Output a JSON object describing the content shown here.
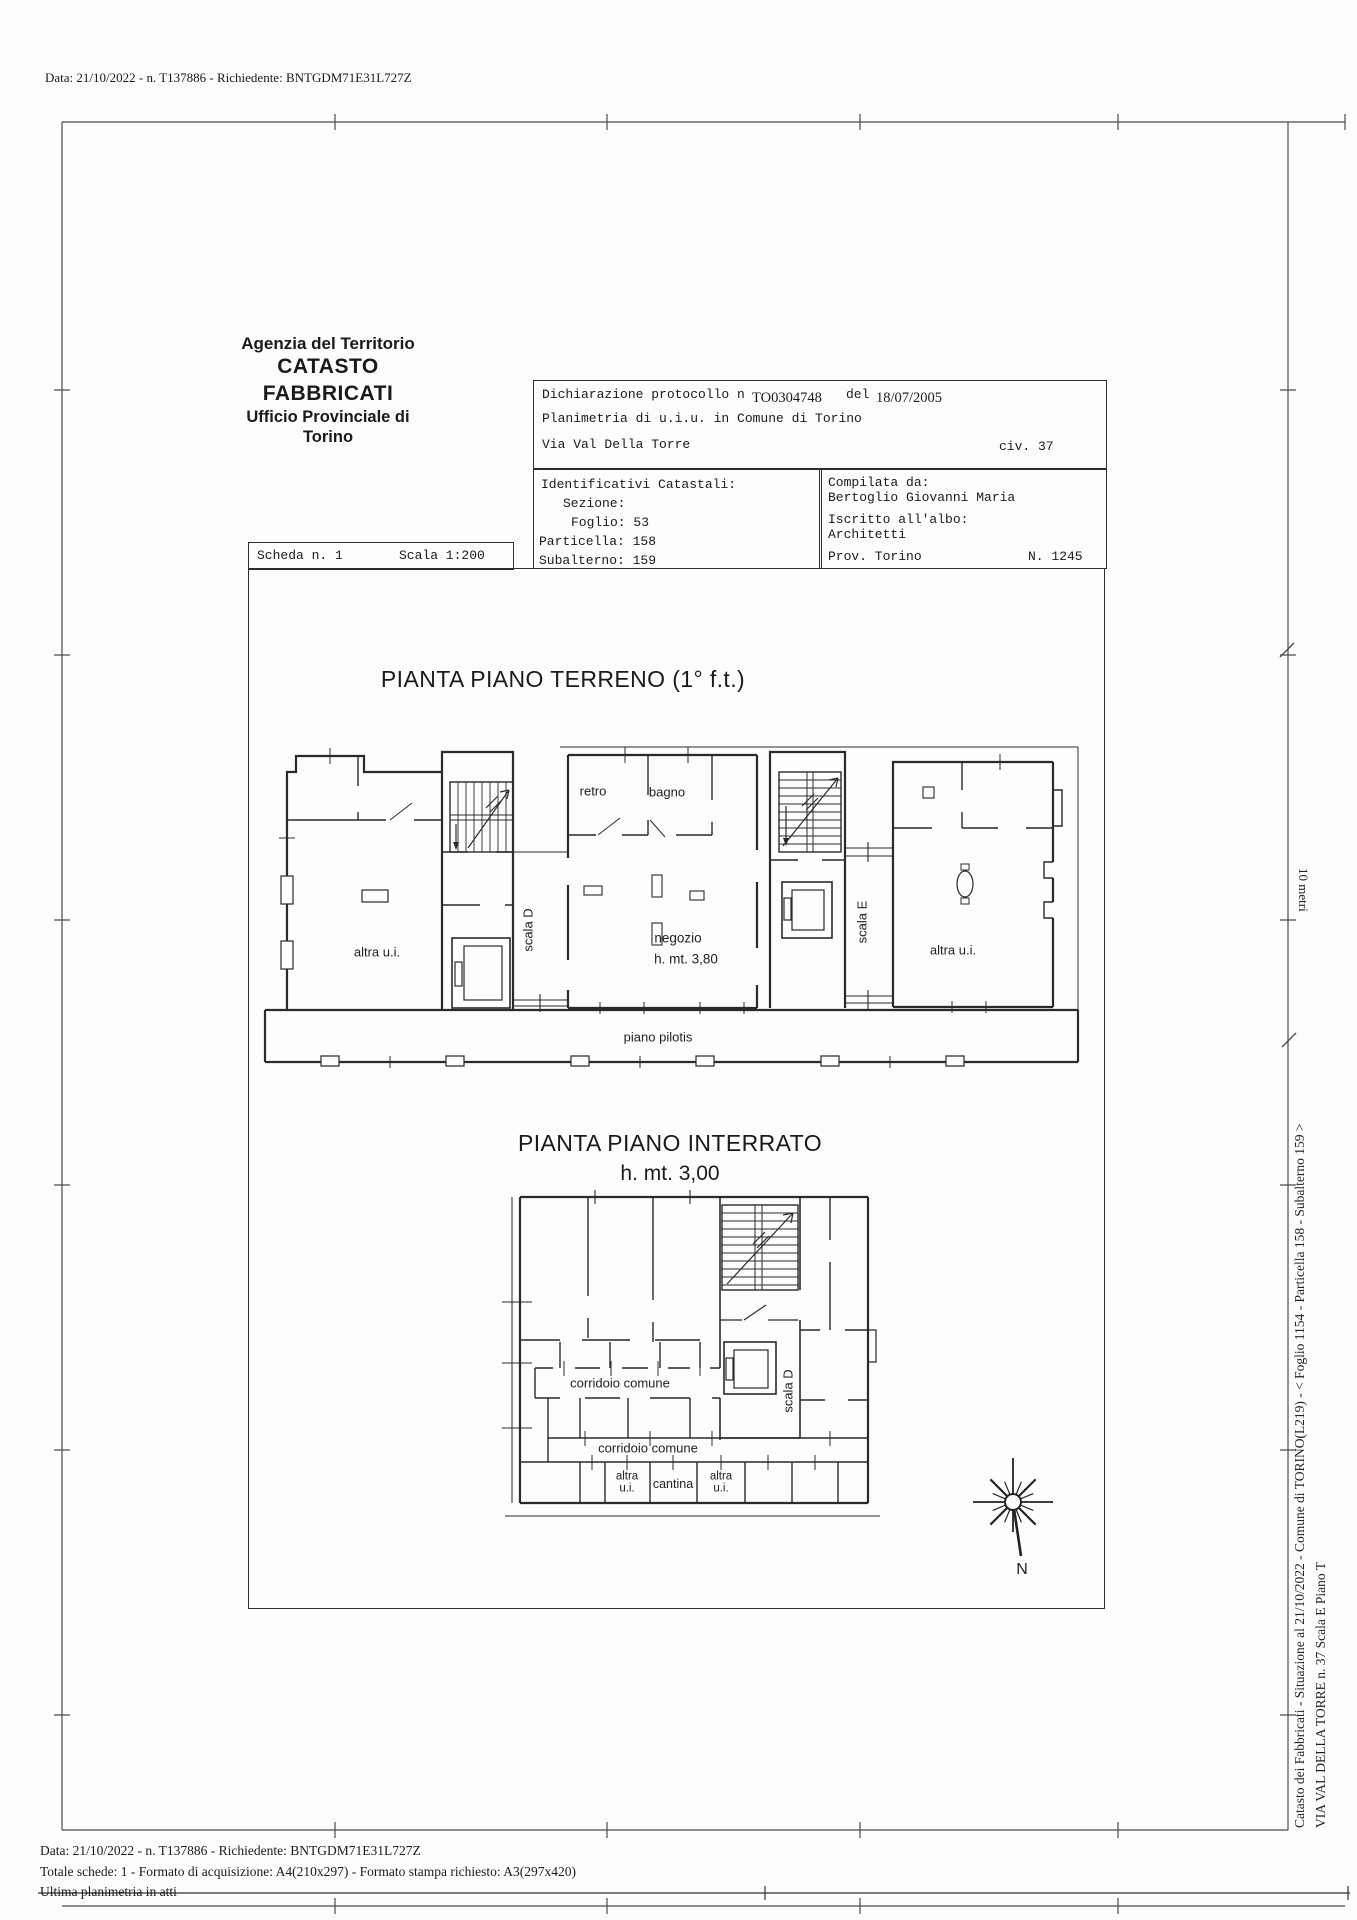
{
  "meta": {
    "top_note": "Data: 21/10/2022 - n. T137886 - Richiedente: BNTGDM71E31L727Z"
  },
  "agency": {
    "line1": "Agenzia del Territorio",
    "line2": "CATASTO FABBRICATI",
    "line3": "Ufficio Provinciale di",
    "line4": "Torino"
  },
  "declaration": {
    "protocol_label": "Dichiarazione protocollo n",
    "protocol_number": "TO0304748",
    "del_label": "del",
    "date": "18/07/2005",
    "line2": "Planimetria di u.i.u. in Comune di Torino",
    "street": "Via Val Della Torre",
    "civic": "civ. 37"
  },
  "catasto_ids": {
    "title": "Identificativi Catastali:",
    "sezione_label": "Sezione:",
    "foglio": "Foglio: 53",
    "particella": "Particella: 158",
    "subalterno": "Subalterno: 159"
  },
  "compiler": {
    "label": "Compilata da:",
    "name": "Bertoglio Giovanni Maria",
    "albo_label": "Iscritto all'albo:",
    "albo_value": "Architetti",
    "prov": "Prov. Torino",
    "number": "N. 1245"
  },
  "scheda": {
    "number": "Scheda n. 1",
    "scale": "Scala 1:200"
  },
  "plan_terreno": {
    "title": "PIANTA PIANO TERRENO (1° f.t.)",
    "labels": {
      "retro": "retro",
      "bagno": "bagno",
      "scala_d": "scala D",
      "scala_e": "scala E",
      "altra_ui_left": "altra u.i.",
      "altra_ui_right": "altra u.i.",
      "negozio": "negozio",
      "negozio_height": "h. mt. 3,80",
      "pilotis": "piano pilotis"
    }
  },
  "plan_interrato": {
    "title": "PIANTA PIANO INTERRATO",
    "subtitle": "h. mt. 3,00",
    "labels": {
      "corridoio1": "corridoio comune",
      "corridoio2": "corridoio comune",
      "scala_d": "scala D",
      "altra1_l1": "altra",
      "altra1_l2": "u.i.",
      "cantina": "cantina",
      "altra2_l1": "altra",
      "altra2_l2": "u.i."
    }
  },
  "compass": {
    "north": "N"
  },
  "scale_bar": {
    "label": "10 metri"
  },
  "right_margin": {
    "line1": "Catasto dei Fabbricati - Situazione al 21/10/2022 - Comune di TORINO(L219) - <  Foglio 1154 - Particella 158 - Subalterno 159 >",
    "line2": "VIA VAL DELLA TORRE n. 37  Scala E Piano T"
  },
  "footer": {
    "line1": "Data: 21/10/2022 - n. T137886 - Richiedente: BNTGDM71E31L727Z",
    "line2": "Totale schede: 1 - Formato di acquisizione: A4(210x297)  - Formato stampa richiesto: A3(297x420)",
    "line3": "Ultima planimetria in atti"
  }
}
